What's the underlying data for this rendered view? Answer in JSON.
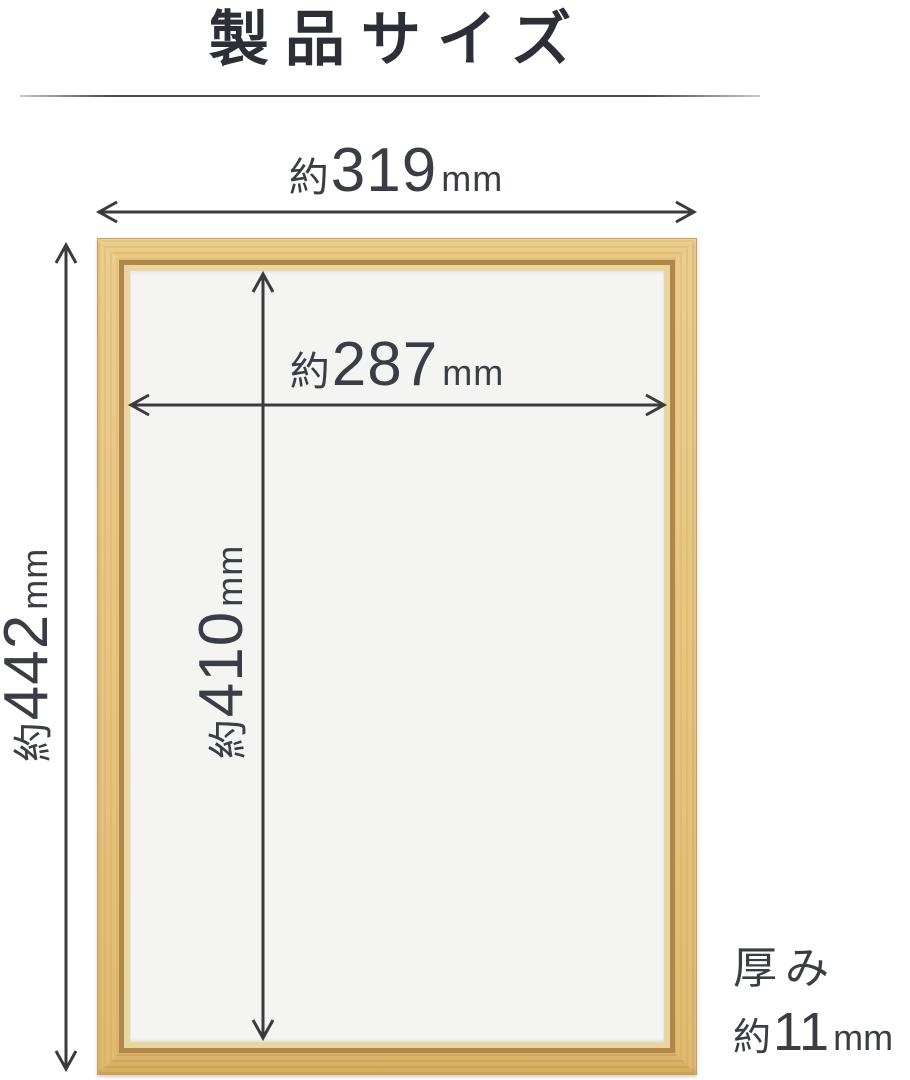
{
  "title": "製品サイズ",
  "dimensions": {
    "outer_width": {
      "approx": "約",
      "value": "319",
      "unit": "mm"
    },
    "inner_width": {
      "approx": "約",
      "value": "287",
      "unit": "mm"
    },
    "outer_height": {
      "approx": "約",
      "value": "442",
      "unit": "mm"
    },
    "inner_height": {
      "approx": "約",
      "value": "410",
      "unit": "mm"
    },
    "thickness": {
      "label": "厚み",
      "approx": "約",
      "value": "11",
      "unit": "mm"
    }
  },
  "colors": {
    "wood_face": "#e7c47e",
    "wood_groove": "#b0874a",
    "wood_lip": "#ead59e",
    "frame_interior": "#f4f4f2",
    "arrow": "#3b3b3f",
    "dimension_text": "#3a3e44",
    "title_text": "#2c2f36"
  }
}
